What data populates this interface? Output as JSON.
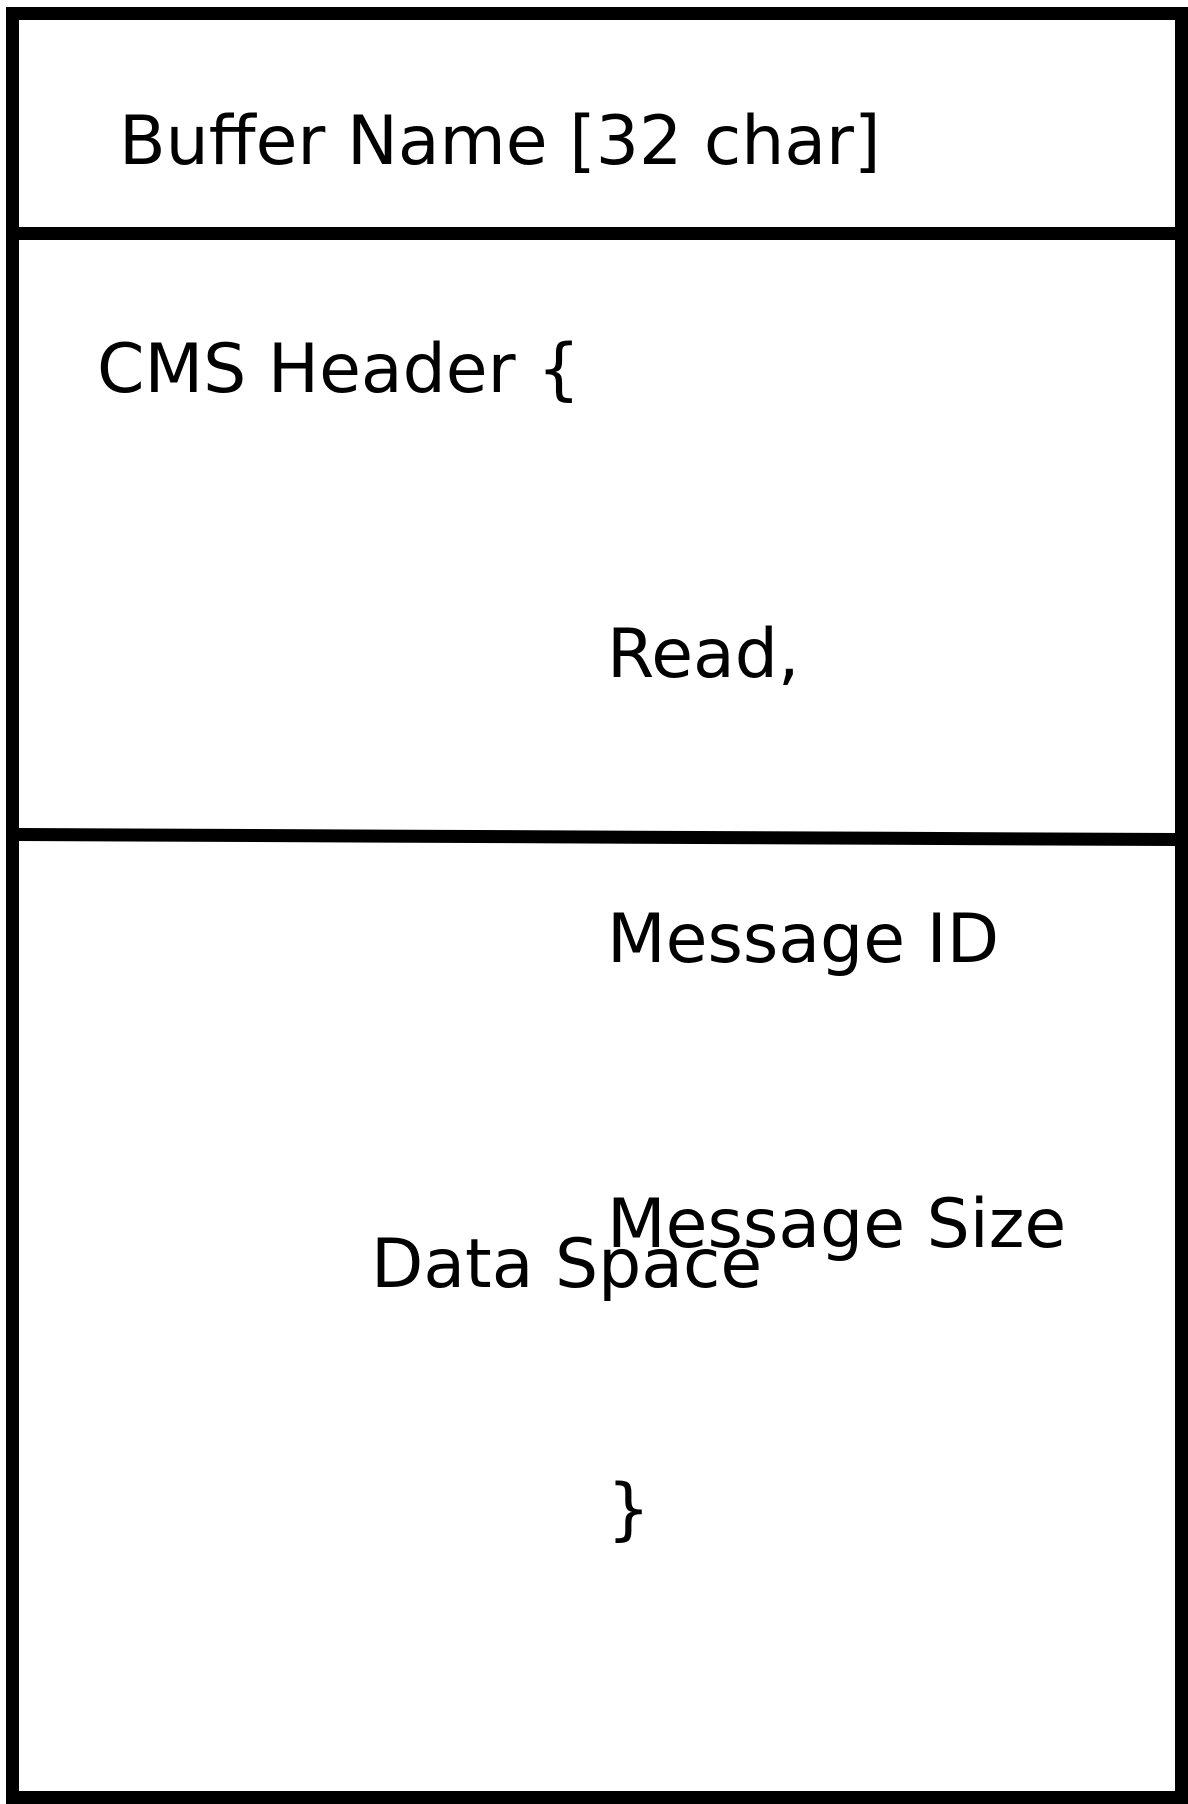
{
  "diagram": {
    "title_section": {
      "label": "Buffer Name [32 char]"
    },
    "header_section": {
      "opening": "CMS Header {",
      "fields": [
        "Read,",
        "Message ID",
        "Message Size"
      ],
      "closing": "}"
    },
    "data_section": {
      "label": "Data Space"
    },
    "colors": {
      "stroke": "#000000",
      "background": "#ffffff",
      "text": "#000000"
    }
  }
}
